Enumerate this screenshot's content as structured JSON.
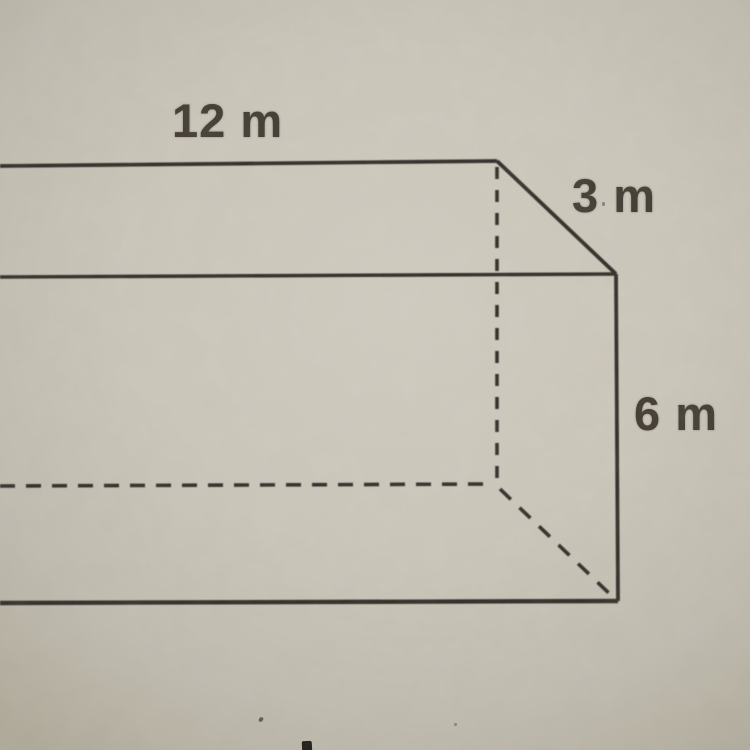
{
  "diagram": {
    "shape": "rectangular-prism",
    "dimension_labels": {
      "length": "12 m",
      "depth": "3 m",
      "height": "6 m"
    },
    "dimensions": {
      "length_value": 12,
      "depth_value": 3,
      "height_value": 6,
      "unit": "m"
    },
    "edge_styles": {
      "visible": "solid",
      "hidden": "dashed"
    }
  },
  "colors": {
    "paper": "#c9c4b8",
    "paper_edge_vignette": "#aba695",
    "line": "#2b2722",
    "label_text": "#3b352c"
  }
}
